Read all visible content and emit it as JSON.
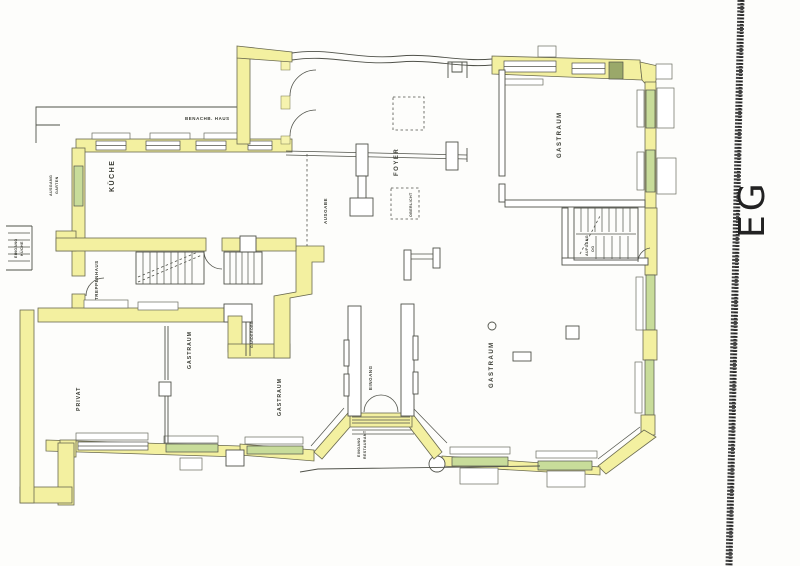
{
  "document": {
    "type": "scanned-floor-plan",
    "floor_annotation": "EG"
  },
  "labels": {
    "kueche": "KÜCHE",
    "foyer": "FOYER",
    "ausgabe": "AUSGABE",
    "oberlicht": "OBERLICHT",
    "gastraum_top_right": "GASTRAUM",
    "gastraum_bottom_right": "GASTRAUM",
    "gastraum_center_left": "GASTRAUM",
    "gastraum_center": "GASTRAUM",
    "privat": "PRIVAT",
    "eingang_vestibule": "EINGANG",
    "eingang_restaurant_1": "EINGANG",
    "eingang_restaurant_2": "RESTAURANT",
    "treppenhaus": "TREPPENHAUS",
    "garderobe": "GARDEROBE",
    "ausgang_garten_1": "AUSGANG",
    "ausgang_garten_2": "GARTEN",
    "eingang_kueche_1": "EINGANG",
    "eingang_kueche_2": "KÜCHE",
    "nachbar_haus": "BENACHB. HAUS",
    "aufgang_1": "AUFGANG",
    "aufgang_2": "OG",
    "eg": "EG"
  },
  "colors": {
    "wall_highlight": "#f3f0a0",
    "window_highlight": "#c8dc9a",
    "plan_line": "#50524a",
    "scan_edge": "#1e1e1e",
    "paper": "#fdfdfb"
  }
}
